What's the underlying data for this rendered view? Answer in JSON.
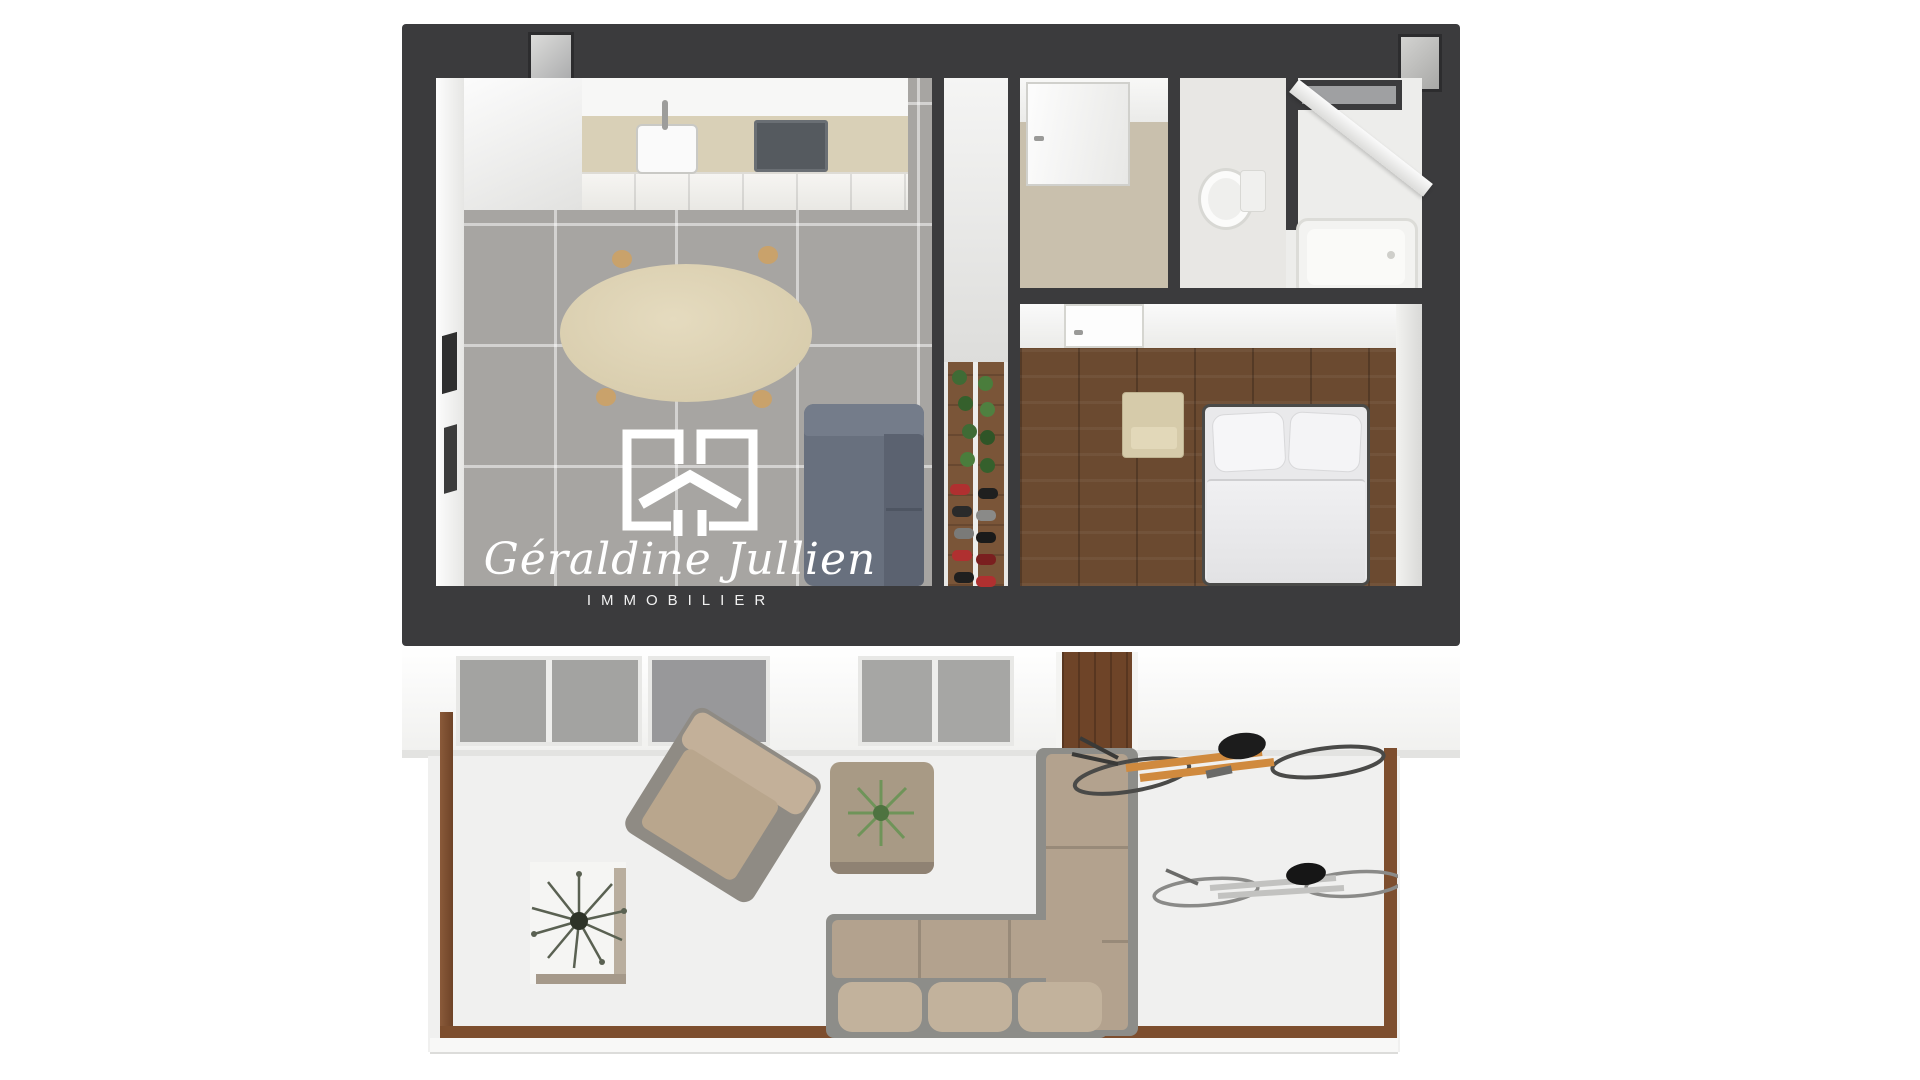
{
  "watermark": {
    "brand_name": "Géraldine Jullien",
    "brand_subtitle": "IMMOBILIER",
    "logo_icon": "house-frame-icon"
  },
  "colors": {
    "background": "#ffffff",
    "wall_dark": "#3b3b3d",
    "wall_white": "#f6f6f4",
    "floor_tile_gray": "#a7a5a2",
    "tile_grout": "#c9c7c4",
    "floor_wood_bedroom": "#6b4a30",
    "floor_hall_beige": "#c9c0ad",
    "kitchen_backsplash": "#d9d0b7",
    "cabinet_white": "#f2f1ee",
    "cooktop_gray": "#555a5f",
    "dining_table_beige": "#ddd2b4",
    "table_leg_wood": "#c9a26b",
    "indoor_sofa_slate": "#68707e",
    "bed_white": "#e9e9eb",
    "nightstand_beige": "#d6cbaa",
    "rack_wood": "#7a5538",
    "plant_green": "#4a7d3c",
    "shoe_red": "#b03030",
    "terrace_floor": "#f0f0ef",
    "terrace_border_wood": "#7d4e2e",
    "outdoor_cushion_beige": "#b3a28e",
    "outdoor_frame_gray": "#8d8d89",
    "bike_orange": "#d08a3e",
    "bike_silver": "#c2c2c0",
    "watermark_white": "#ffffff"
  },
  "scene": {
    "type": "3d-floor-plan-dollhouse-view",
    "rooms": [
      {
        "name": "kitchen-living-room",
        "floor": "gray-tile",
        "items": [
          "kitchen-counter",
          "sink",
          "cooktop",
          "tall-cabinet",
          "oval-dining-table",
          "slate-gray-sofa",
          "wall-art-frames"
        ]
      },
      {
        "name": "shoe-rack-corridor",
        "floor": "wood",
        "items": [
          "shoe-rack",
          "green-plants",
          "shoes"
        ]
      },
      {
        "name": "entrance-hall",
        "floor": "beige-screed",
        "items": [
          "front-door"
        ]
      },
      {
        "name": "wc",
        "floor": "light-gray",
        "items": [
          "toilet"
        ]
      },
      {
        "name": "bathroom",
        "floor": "light-gray",
        "items": [
          "bathtub",
          "glass-window",
          "shower-screen"
        ]
      },
      {
        "name": "bedroom",
        "floor": "dark-wood-planks",
        "items": [
          "double-bed",
          "two-pillows",
          "nightstand",
          "door"
        ]
      },
      {
        "name": "terrace",
        "floor": "white-slab-with-wood-border",
        "items": [
          "dried-plant-table",
          "outdoor-armchair",
          "pouf-with-plant",
          "l-shaped-outdoor-sofa",
          "orange-bicycle",
          "silver-bicycle"
        ]
      }
    ]
  }
}
